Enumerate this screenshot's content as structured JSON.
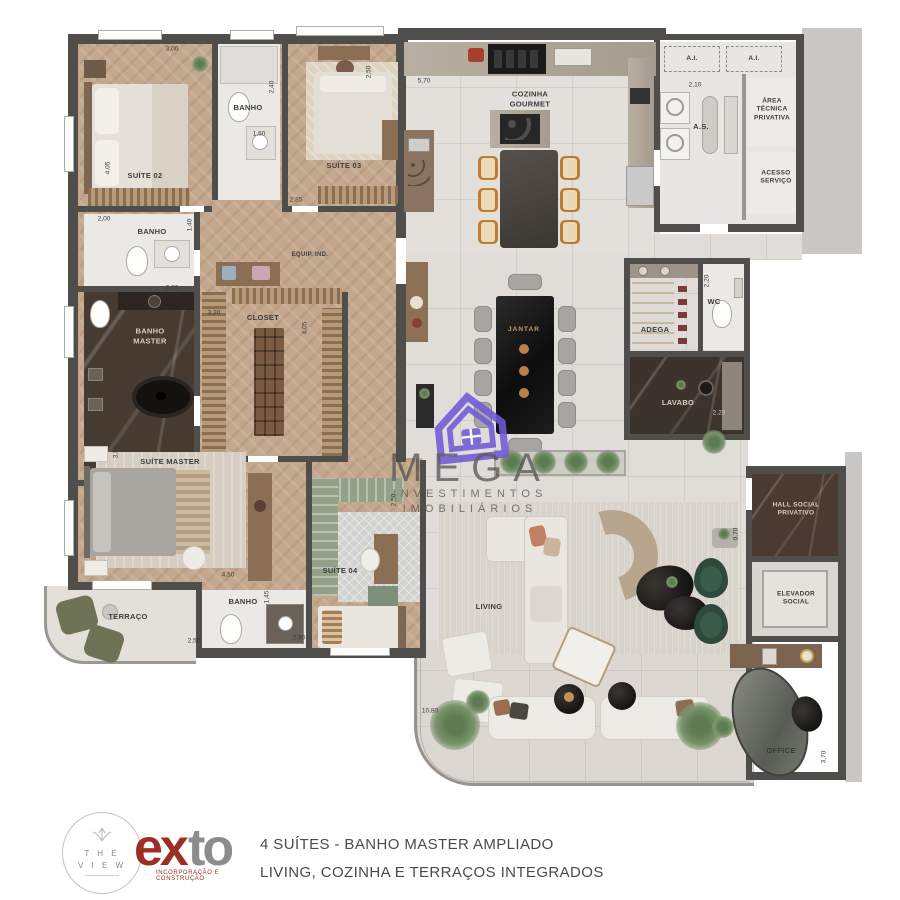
{
  "plan": {
    "rooms": [
      {
        "label": "SUÍTE 02"
      },
      {
        "label": "BANHO"
      },
      {
        "label": "SUÍTE 03"
      },
      {
        "label": "BANHO"
      },
      {
        "label": "BANHO\nMASTER"
      },
      {
        "label": "CLOSET"
      },
      {
        "label": "EQUIP. IND."
      },
      {
        "label": "SUÍTE MASTER"
      },
      {
        "label": "TERRAÇO"
      },
      {
        "label": "BANHO"
      },
      {
        "label": "SUÍTE 04"
      },
      {
        "label": "COZINHA\nGOURMET"
      },
      {
        "label": "A.I."
      },
      {
        "label": "A.I."
      },
      {
        "label": "A.S."
      },
      {
        "label": "ÁREA\nTÉCNICA\nPRIVATIVA"
      },
      {
        "label": "ACESSO\nSERVIÇO"
      },
      {
        "label": "ADEGA"
      },
      {
        "label": "WC"
      },
      {
        "label": "LAVABO"
      },
      {
        "label": "JANTAR"
      },
      {
        "label": "LIVING"
      },
      {
        "label": "HALL SOCIAL\nPRIVATIVO"
      },
      {
        "label": "ELEVADOR\nSOCIAL"
      },
      {
        "label": "OFFICE"
      }
    ],
    "dims": [
      "3,00",
      "2,40",
      "1,60",
      "2,85",
      "2,50",
      "4,05",
      "2,00",
      "1,40",
      "2,60",
      "3,30",
      "4,05",
      "3,50",
      "4,50",
      "1,45",
      "2,50",
      "2,80",
      "5,70",
      "2,10",
      "2,20",
      "2,20",
      "0,70",
      "10,80",
      "3,70",
      "2,50"
    ]
  },
  "watermark": {
    "brand": "MEGA",
    "line1": "INVESTIMENTOS",
    "line2": "IMOBILIÁRIOS"
  },
  "footer": {
    "the_view_line1": "T H E",
    "the_view_line2": "V I E W",
    "exto_part1": "ex",
    "exto_part2": "to",
    "exto_subtitle": "INCORPORAÇÃO E CONSTRUÇÃO",
    "caption_line1": "4 SUÍTES - BANHO MASTER AMPLIADO",
    "caption_line2": "LIVING, COZINHA E TERRAÇOS INTEGRADOS"
  },
  "colors": {
    "wall": "#504e4a",
    "wood": "#c3a88d",
    "tile": "#e0ddd8",
    "dark_marble": "#473a31",
    "watermark_purple": "#6f5bd6",
    "exto_red": "#9c2f23",
    "accent_green": "#2d4a3c"
  }
}
